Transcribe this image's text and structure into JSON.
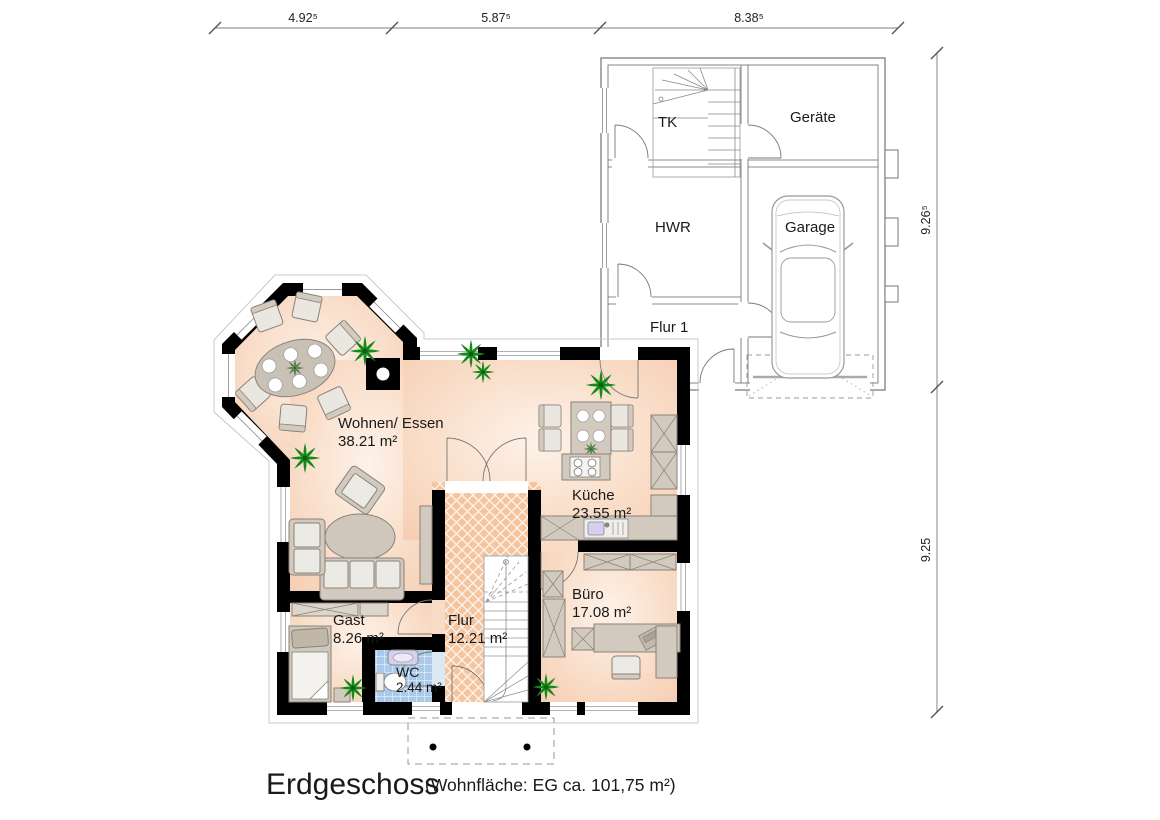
{
  "plan": {
    "title": "Erdgeschoss",
    "subtitle": "(Wohnfläche: EG  ca. 101,75 m²)"
  },
  "dimensions": {
    "top": [
      "4.92⁵",
      "5.87⁵",
      "8.38⁵"
    ],
    "right": [
      "9.26⁵",
      "9.25"
    ]
  },
  "rooms": {
    "tk": {
      "name": "TK"
    },
    "geraete": {
      "name": "Geräte"
    },
    "hwr": {
      "name": "HWR"
    },
    "garage": {
      "name": "Garage"
    },
    "flur1": {
      "name": "Flur 1"
    },
    "wohnen": {
      "name": "Wohnen/ Essen",
      "area": "38.21 m²"
    },
    "kueche": {
      "name": "Küche",
      "area": "23.55 m²"
    },
    "buero": {
      "name": "Büro",
      "area": "17.08 m²"
    },
    "gast": {
      "name": "Gast",
      "area": "8.26 m²"
    },
    "flur": {
      "name": "Flur",
      "area": "12.21 m²"
    },
    "wc": {
      "name": "WC",
      "area": "2.44 m²"
    }
  },
  "colors": {
    "wall": "#000000",
    "room_fill_light": "#fdf1e8",
    "room_fill_dark": "#f5cbae",
    "flur_tile": "#f5c5a0",
    "wc_tile": "#abc9e8",
    "furniture": "#d2cabf",
    "cushion": "#eceae4",
    "plant_green": "#158a1b",
    "annex_line": "#666666",
    "dimension_line": "#999999"
  }
}
